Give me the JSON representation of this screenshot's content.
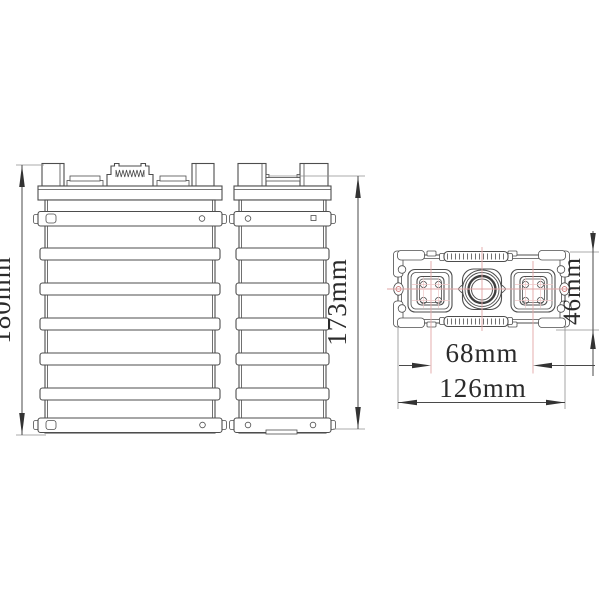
{
  "drawing": {
    "type": "battery-cell-orthographic-views",
    "dimensions": {
      "front_height": "180mm",
      "side_height": "173mm",
      "top_depth": "46mm",
      "terminal_spacing": "68mm",
      "overall_width": "126mm"
    },
    "colors": {
      "line": "#4d4d4d",
      "centerline": "#e2a6a6",
      "extension_line": "#8f8f8f",
      "dimension_text": "#2b2b2b",
      "background": "#ffffff"
    }
  }
}
